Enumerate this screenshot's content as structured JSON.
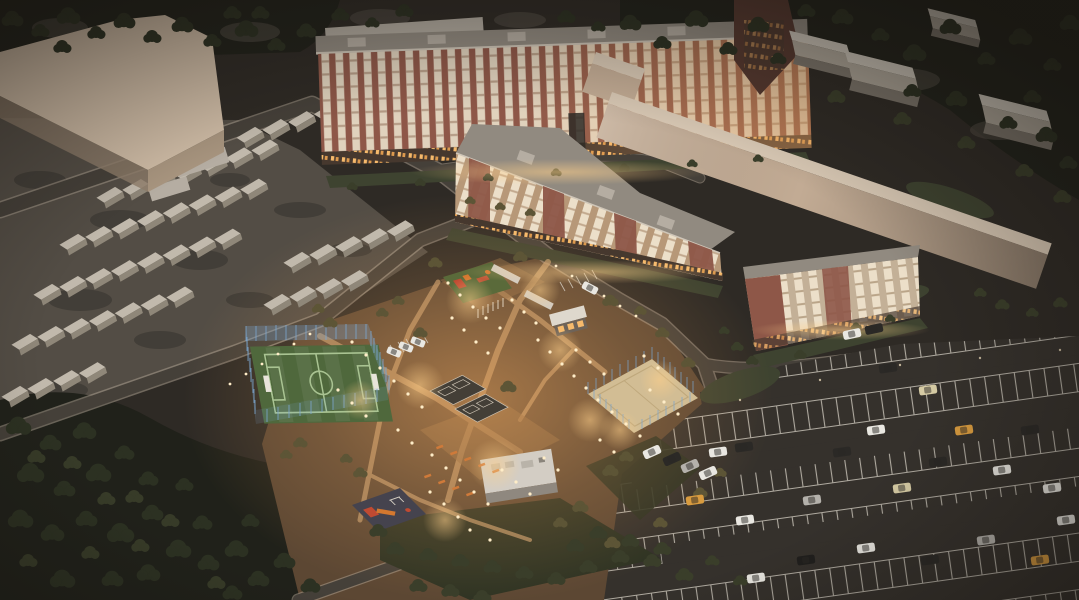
{
  "scene": {
    "description": "Aerial dusk 3D architectural rendering of a residential quarter: apartment blocks with lit windows, warm-lit landscaped courtyard with fenced soccer field, sand court, playgrounds, rows of garages, industrial sheds and a large striped parking lot with cars",
    "time_of_day": "dusk",
    "lighting": "warm courtyard lamps, dark desaturated surroundings"
  },
  "elements": {
    "apartment_bar": "long nine-story apartment building",
    "apartment_wing": "five-story courtyard apartment wing",
    "apartment_small": "four-story apartment building",
    "warehouse_slab": "long windowless warehouse slab",
    "industrial_shed": "gabled industrial shed",
    "garage": "garage box row",
    "soccer_field": "fenced mini football pitch",
    "sand_court": "fenced sand sports court",
    "sport_court": "dark rubber sport court",
    "playground": "children playground",
    "kiosk": "small lit pavilion",
    "service_building": "flat-roof service building",
    "parking_lot": "striped parking lot",
    "car": "parked car",
    "tree": "tree mass",
    "street_lamp": "courtyard light point"
  },
  "palette": {
    "ground": "#474139",
    "groundDark": "#2e2a25",
    "gravel": "#59534b",
    "forest": "#20211a",
    "treeDark": "#2c3122",
    "treeMid": "#3a3e2a",
    "treeWarm": "#5d5536",
    "road": "#454039",
    "curb": "#b2a595",
    "asphaltLot": "#35312c",
    "stallLine": "#d8d2c6",
    "pathTan": "#c29a6c",
    "plazaTan": "#8a6844",
    "glowWarm": "#f2a95e",
    "lampGlow": "#ffd08a",
    "lightDot": "#ffedc8",
    "roofGray": "#918a80",
    "roofLight": "#b5ada2",
    "parapet": "#cfc6b8",
    "brick": "#8e5748",
    "brickDark": "#55382f",
    "stucco": "#b79878",
    "stucco2": "#c3b097",
    "balconyLight": "#e0d2bd",
    "balconyLight2": "#ecdfc9",
    "groundFloor": "#46382e",
    "windowWarm": "#f6ba6c",
    "slabTop": "#d8c8b4",
    "slabWall": "#c2ab94",
    "tlRoof": "#cfbca6",
    "tlFace": "#a8957f",
    "grayRoof": "#b3aca1",
    "grayFace": "#8f887d",
    "shedRoofA": "#cfc8bc",
    "shedRoofB": "#b0a89b",
    "shedFace": "#7d766c",
    "garRoof": "#c1b9ac",
    "garFace": "#8f8779",
    "fieldGreen": "#4f683c",
    "fieldLine": "#a9c392",
    "fenceBlue": "#7ba6cf",
    "sand": "#d2bd94",
    "courtDark": "#443f37",
    "matGreen": "#5a6a3a",
    "matDark": "#45434e",
    "equipRed": "#c04a32",
    "equipOrange": "#d4782f",
    "bench": "#cf7a3a",
    "kioskWhite": "#ded8cd",
    "svcRoof": "#d3cdc4",
    "svcFace": "#8f887f",
    "grass": "#3e4330",
    "hedge": "#2e3323",
    "carWhite": "#e9e7e1",
    "carSilver": "#b4b1ab",
    "carDark": "#2b2926",
    "carBlack": "#201f1d",
    "carAmber": "#d89b3f",
    "carBeige": "#d6cba4"
  }
}
